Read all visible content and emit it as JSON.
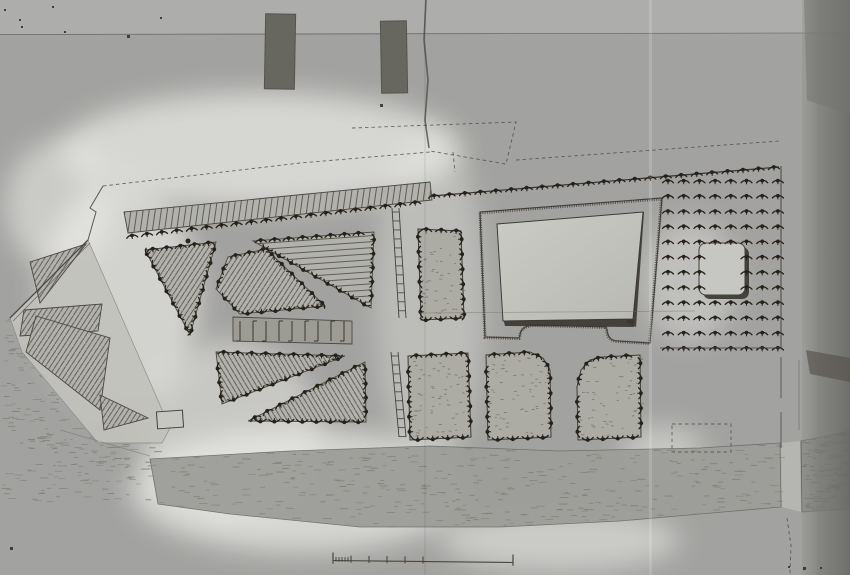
{
  "photo": {
    "kind": "archival-photograph-of-estate-garden-plan",
    "colors": {
      "bg": "#a2a2a0",
      "bg_top": "#adadab",
      "ink": "#2a2620",
      "ink_soft": "#45413b",
      "hatch": "#56524b",
      "bed_fill": "#b2b2ac",
      "plot_fill": "#acaca5",
      "walk_fill": "#c2c2bd",
      "garden_light": "#cbcbc6",
      "garden_mid": "#b9b9b3",
      "shadow": "#3a362f",
      "river_fill": "#9d9d99",
      "river2_fill": "#8f8f8b",
      "river_dash": "#7e7e77",
      "stain": "#ecece9",
      "strip": "#6e6e6a",
      "dark_object": "#67675f",
      "tree": "#262219"
    },
    "artifacts": {
      "top_strip_h": 34,
      "dark_rects": [
        {
          "x": 265,
          "y": 14,
          "w": 30,
          "h": 75,
          "rot": 1
        },
        {
          "x": 381,
          "y": 21,
          "w": 26,
          "h": 72,
          "rot": -1
        }
      ],
      "specks": [
        [
          4,
          9,
          2
        ],
        [
          52,
          6,
          2
        ],
        [
          19,
          19,
          2
        ],
        [
          21,
          26,
          2
        ],
        [
          64,
          31,
          2
        ],
        [
          127,
          35,
          3
        ],
        [
          160,
          17,
          2
        ],
        [
          380,
          104,
          3
        ],
        [
          10,
          547,
          3
        ],
        [
          788,
          566,
          2
        ],
        [
          803,
          567,
          3
        ],
        [
          820,
          567,
          2
        ]
      ],
      "fold_dark_x": [
        [
          426,
          0
        ],
        [
          424,
          40
        ],
        [
          428,
          80
        ],
        [
          425,
          120
        ],
        [
          429,
          148
        ]
      ],
      "fold_light_x": 649,
      "stains": [
        {
          "cx": 260,
          "cy": 150,
          "rx": 200,
          "ry": 58,
          "o": 0.7
        },
        {
          "cx": 120,
          "cy": 295,
          "rx": 80,
          "ry": 115,
          "o": 0.65
        },
        {
          "cx": 230,
          "cy": 430,
          "rx": 90,
          "ry": 90,
          "o": 0.5
        },
        {
          "cx": 300,
          "cy": 490,
          "rx": 170,
          "ry": 62,
          "o": 0.7
        },
        {
          "cx": 430,
          "cy": 300,
          "rx": 55,
          "ry": 170,
          "o": 0.35
        },
        {
          "cx": 560,
          "cy": 540,
          "rx": 120,
          "ry": 32,
          "o": 0.55
        },
        {
          "cx": 690,
          "cy": 280,
          "rx": 48,
          "ry": 62,
          "o": 0.4
        },
        {
          "cx": 662,
          "cy": 452,
          "rx": 42,
          "ry": 26,
          "o": 0.5
        },
        {
          "cx": 60,
          "cy": 205,
          "rx": 55,
          "ry": 65,
          "o": 0.55
        }
      ],
      "right_strip": {
        "x": 802,
        "w": 48,
        "top_wedge": [
          [
            804,
            0
          ],
          [
            850,
            0
          ],
          [
            850,
            115
          ],
          [
            807,
            100
          ]
        ],
        "dark_patch": [
          [
            806,
            350
          ],
          [
            850,
            358
          ],
          [
            850,
            382
          ],
          [
            810,
            374
          ]
        ]
      }
    },
    "plan": {
      "beds": [
        {
          "id": "north-shelter-belt",
          "pts": [
            [
              124,
              212
            ],
            [
              430,
              182
            ],
            [
              432,
              200
            ],
            [
              128,
              233
            ]
          ],
          "hatch": "v",
          "trees": false
        },
        {
          "id": "bed-left-triangle",
          "pts": [
            [
              145,
              250
            ],
            [
              216,
              242
            ],
            [
              190,
              335
            ]
          ],
          "hatch": "d1",
          "trees": true
        },
        {
          "id": "bed-upper-right-triangle",
          "pts": [
            [
              253,
              241
            ],
            [
              374,
              232
            ],
            [
              371,
              308
            ]
          ],
          "hatch": "h",
          "trees": true
        },
        {
          "id": "bed-upper-wedge",
          "pts": [
            [
              228,
              257
            ],
            [
              266,
              249
            ],
            [
              325,
              306
            ],
            [
              240,
              314
            ],
            [
              216,
              289
            ]
          ],
          "hatch": "d1",
          "trees": true
        },
        {
          "id": "bed-lower-wedge",
          "pts": [
            [
              216,
              352
            ],
            [
              345,
              356
            ],
            [
              222,
              404
            ]
          ],
          "hatch": "d2",
          "trees": true
        },
        {
          "id": "bed-lower-right-triangle",
          "pts": [
            [
              248,
              421
            ],
            [
              365,
              362
            ],
            [
              366,
              422
            ]
          ],
          "hatch": "d2",
          "trees": true
        },
        {
          "id": "west-plot-1",
          "pts": [
            [
              30,
              262
            ],
            [
              86,
              244
            ],
            [
              40,
              303
            ]
          ],
          "hatch": "d1",
          "trees": false
        },
        {
          "id": "west-plot-2",
          "pts": [
            [
              24,
              310
            ],
            [
              102,
              304
            ],
            [
              98,
              331
            ],
            [
              20,
              336
            ]
          ],
          "hatch": "d1",
          "trees": false
        },
        {
          "id": "west-plot-3",
          "pts": [
            [
              36,
              316
            ],
            [
              110,
              338
            ],
            [
              100,
              410
            ],
            [
              26,
              352
            ]
          ],
          "hatch": "d1",
          "trees": false
        },
        {
          "id": "west-plot-4",
          "pts": [
            [
              100,
              395
            ],
            [
              148,
              418
            ],
            [
              104,
              430
            ]
          ],
          "hatch": "d1",
          "trees": false
        }
      ],
      "west_block_outline": [
        [
          10,
          318
        ],
        [
          88,
          240
        ],
        [
          170,
          428
        ],
        [
          162,
          443
        ],
        [
          98,
          443
        ],
        [
          22,
          352
        ]
      ],
      "west_block_rect": {
        "x": 157,
        "y": 411,
        "w": 26,
        "h": 17,
        "rot": -4
      },
      "middle_band": {
        "pts": [
          [
            233,
            317
          ],
          [
            352,
            321
          ],
          [
            352,
            344
          ],
          [
            233,
            341
          ]
        ],
        "hook_step": 13
      },
      "ladders": [
        {
          "x1": 392,
          "y1": 208,
          "x2": 399,
          "y2": 318,
          "w": 7,
          "rung": 9
        },
        {
          "x1": 391,
          "y1": 352,
          "x2": 399,
          "y2": 437,
          "w": 7,
          "rung": 9
        }
      ],
      "plots": [
        {
          "id": "paddock-upper",
          "pts": [
            [
              418,
              229
            ],
            [
              461,
              231
            ],
            [
              464,
              318
            ],
            [
              421,
              320
            ]
          ]
        },
        {
          "id": "paddock-a",
          "pts": [
            [
              408,
              356
            ],
            [
              468,
              353
            ],
            [
              471,
              437
            ],
            [
              410,
              440
            ]
          ]
        },
        {
          "id": "paddock-b",
          "pts": [
            [
              486,
              355
            ],
            [
              530,
              352
            ],
            [
              543,
              358
            ],
            [
              550,
              370
            ],
            [
              551,
              437
            ],
            [
              488,
              440
            ]
          ]
        },
        {
          "id": "paddock-c",
          "pts": [
            [
              577,
              387
            ],
            [
              581,
              370
            ],
            [
              590,
              360
            ],
            [
              603,
              357
            ],
            [
              640,
              355
            ],
            [
              641,
              437
            ],
            [
              578,
              440
            ]
          ]
        }
      ],
      "garden": {
        "outer_path": "M480,212 L662,198 L650,343 L618,341 Q608,341 607,330 L606,327 L536,325 Q521,325 520,335 L519,338 L485,337 Z",
        "inner_pts": [
          [
            497,
            224
          ],
          [
            643,
            212
          ],
          [
            633,
            319
          ],
          [
            503,
            321
          ]
        ],
        "shadow_right": [
          [
            635,
            212
          ],
          [
            644,
            212
          ],
          [
            636,
            327
          ],
          [
            627,
            323
          ]
        ],
        "shadow_bottom": [
          [
            503,
            318
          ],
          [
            633,
            318
          ],
          [
            634,
            327
          ],
          [
            505,
            326
          ]
        ]
      },
      "orchard": {
        "x0": 668,
        "dx": 15.7,
        "cols": 8,
        "y0": 181,
        "dy": 15.2,
        "rows": 12,
        "square": {
          "x": 699,
          "y": 243,
          "w": 46,
          "h": 52,
          "r": 7
        },
        "exclude": {
          "x1": 703,
          "x2": 742,
          "y1": 246,
          "y2": 292
        }
      },
      "tree_lines": [
        {
          "from": [
            130,
            236
          ],
          "to": [
            428,
            201
          ],
          "sp": 15
        },
        {
          "from": [
            432,
            196
          ],
          "to": [
            779,
            167
          ],
          "sp": 15.5,
          "line": true
        }
      ],
      "lone_dot": [
        188,
        241,
        2.5
      ],
      "lines": [
        {
          "pts": [
            [
              0,
              34.5
            ],
            [
              850,
              33
            ]
          ],
          "w": 0.8,
          "c": "#56534d",
          "o": 0.75
        },
        {
          "pts": [
            [
              10,
              318
            ],
            [
              88,
              240
            ]
          ],
          "w": 1.3,
          "c": "#45413b",
          "o": 0.9
        },
        {
          "pts": [
            [
              13,
              321
            ],
            [
              90,
              243
            ]
          ],
          "w": 0.7,
          "c": "#45413b",
          "o": 0.7
        },
        {
          "pts": [
            [
              88,
              240
            ],
            [
              96,
              212
            ],
            [
              90,
              208
            ],
            [
              103,
              186
            ]
          ],
          "w": 1.0,
          "c": "#45413b",
          "o": 0.85
        },
        {
          "pts": [
            [
              60,
              430
            ],
            [
              150,
              456
            ]
          ],
          "w": 0.8,
          "c": "#6b675f",
          "o": 0.5
        },
        {
          "pts": [
            [
              420,
              313
            ],
            [
              695,
              311
            ]
          ],
          "w": 0.8,
          "c": "#6b675f",
          "o": 0.45
        },
        {
          "pts": [
            [
              660,
              348
            ],
            [
              781,
              348
            ]
          ],
          "w": 0.9,
          "c": "#45413b",
          "o": 0.8
        },
        {
          "pts": [
            [
              781,
              166
            ],
            [
              781,
              348
            ]
          ],
          "w": 1.1,
          "c": "#45413b",
          "o": 0.85
        },
        {
          "pts": [
            [
              781,
              357
            ],
            [
              781,
              398
            ]
          ],
          "w": 1.0,
          "c": "#4f4b44",
          "o": 0.8
        },
        {
          "pts": [
            [
              781,
              412
            ],
            [
              781,
              448
            ]
          ],
          "w": 1.0,
          "c": "#4f4b44",
          "o": 0.8
        },
        {
          "pts": [
            [
              799,
              360
            ],
            [
              799,
              430
            ]
          ],
          "w": 0.7,
          "c": "#4f4b44",
          "o": 0.55
        }
      ],
      "dashed": [
        {
          "pts": [
            [
              103,
              186
            ],
            [
              300,
              163
            ],
            [
              430,
              152
            ]
          ]
        },
        {
          "pts": [
            [
              352,
              128
            ],
            [
              516,
              122
            ],
            [
              506,
              164
            ],
            [
              430,
              151
            ]
          ]
        },
        {
          "pts": [
            [
              516,
              160
            ],
            [
              780,
              141
            ]
          ]
        },
        {
          "pts": [
            [
              453,
              152
            ],
            [
              455,
              172
            ]
          ]
        },
        {
          "pts": [
            [
              672,
              424
            ],
            [
              731,
              424
            ],
            [
              731,
              452
            ],
            [
              672,
              452
            ],
            [
              672,
              424
            ]
          ]
        },
        {
          "pts": [
            [
              787,
              518
            ],
            [
              791,
              545
            ],
            [
              790,
              574
            ]
          ]
        }
      ],
      "river": {
        "main": [
          [
            150,
            459
          ],
          [
            290,
            451
          ],
          [
            430,
            446
          ],
          [
            560,
            451
          ],
          [
            700,
            448
          ],
          [
            780,
            443
          ],
          [
            781,
            507
          ],
          [
            700,
            514
          ],
          [
            620,
            521
          ],
          [
            500,
            527
          ],
          [
            360,
            527
          ],
          [
            230,
            514
          ],
          [
            158,
            504
          ]
        ],
        "gap": [
          [
            781,
            443
          ],
          [
            800,
            441
          ],
          [
            801,
            512
          ],
          [
            782,
            507
          ]
        ],
        "east": [
          [
            801,
            441
          ],
          [
            850,
            431
          ],
          [
            850,
            509
          ],
          [
            802,
            512
          ]
        ]
      },
      "water_textures": [
        {
          "poly": "river_main",
          "density": 0.008,
          "dark": false
        },
        {
          "poly": "river_east",
          "density": 0.03,
          "dark": true
        },
        {
          "poly": [
            [
              0,
              324
            ],
            [
              28,
              303
            ],
            [
              60,
              345
            ],
            [
              100,
              428
            ],
            [
              160,
              443
            ],
            [
              152,
              470
            ],
            [
              60,
              458
            ],
            [
              0,
              432
            ]
          ],
          "density": 0.012,
          "dark": false
        },
        {
          "poly": [
            [
              0,
              436
            ],
            [
              148,
              458
            ],
            [
              156,
              504
            ],
            [
              0,
              502
            ]
          ],
          "density": 0.009,
          "dark": false
        }
      ],
      "scalebar": {
        "x1": 333,
        "y1": 560.5,
        "x2": 513,
        "y2": 562.5,
        "fine_until": 351,
        "fine_step": 3,
        "major": [
          351,
          369,
          387,
          405,
          423
        ],
        "tick_h": 5,
        "end_h": 8
      }
    }
  }
}
